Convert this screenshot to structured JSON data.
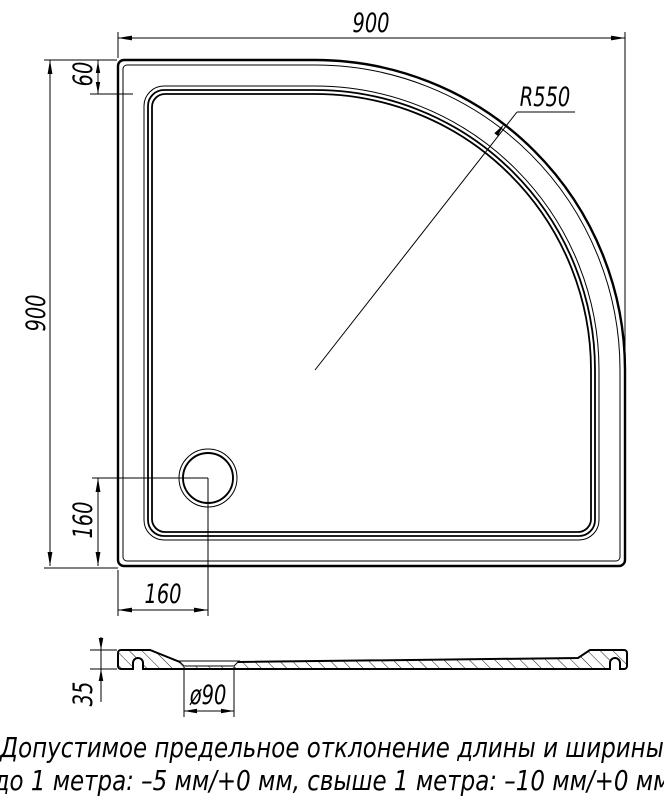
{
  "title": "Shower tray technical drawing",
  "dimensions": {
    "width": "900",
    "height": "900",
    "rim_offset": "60",
    "drain_offset_x": "160",
    "drain_offset_y": "160",
    "corner_radius": "R550",
    "tray_depth": "35",
    "drain_diameter": "ø90"
  },
  "note": {
    "line1": "Допустимое предельное отклонение длины и ширины",
    "line2": "до 1 метра: –5 мм/+0 мм, свыше 1 метра: –10 мм/+0 мм"
  },
  "colors": {
    "line": "#000000",
    "background": "#ffffff"
  }
}
